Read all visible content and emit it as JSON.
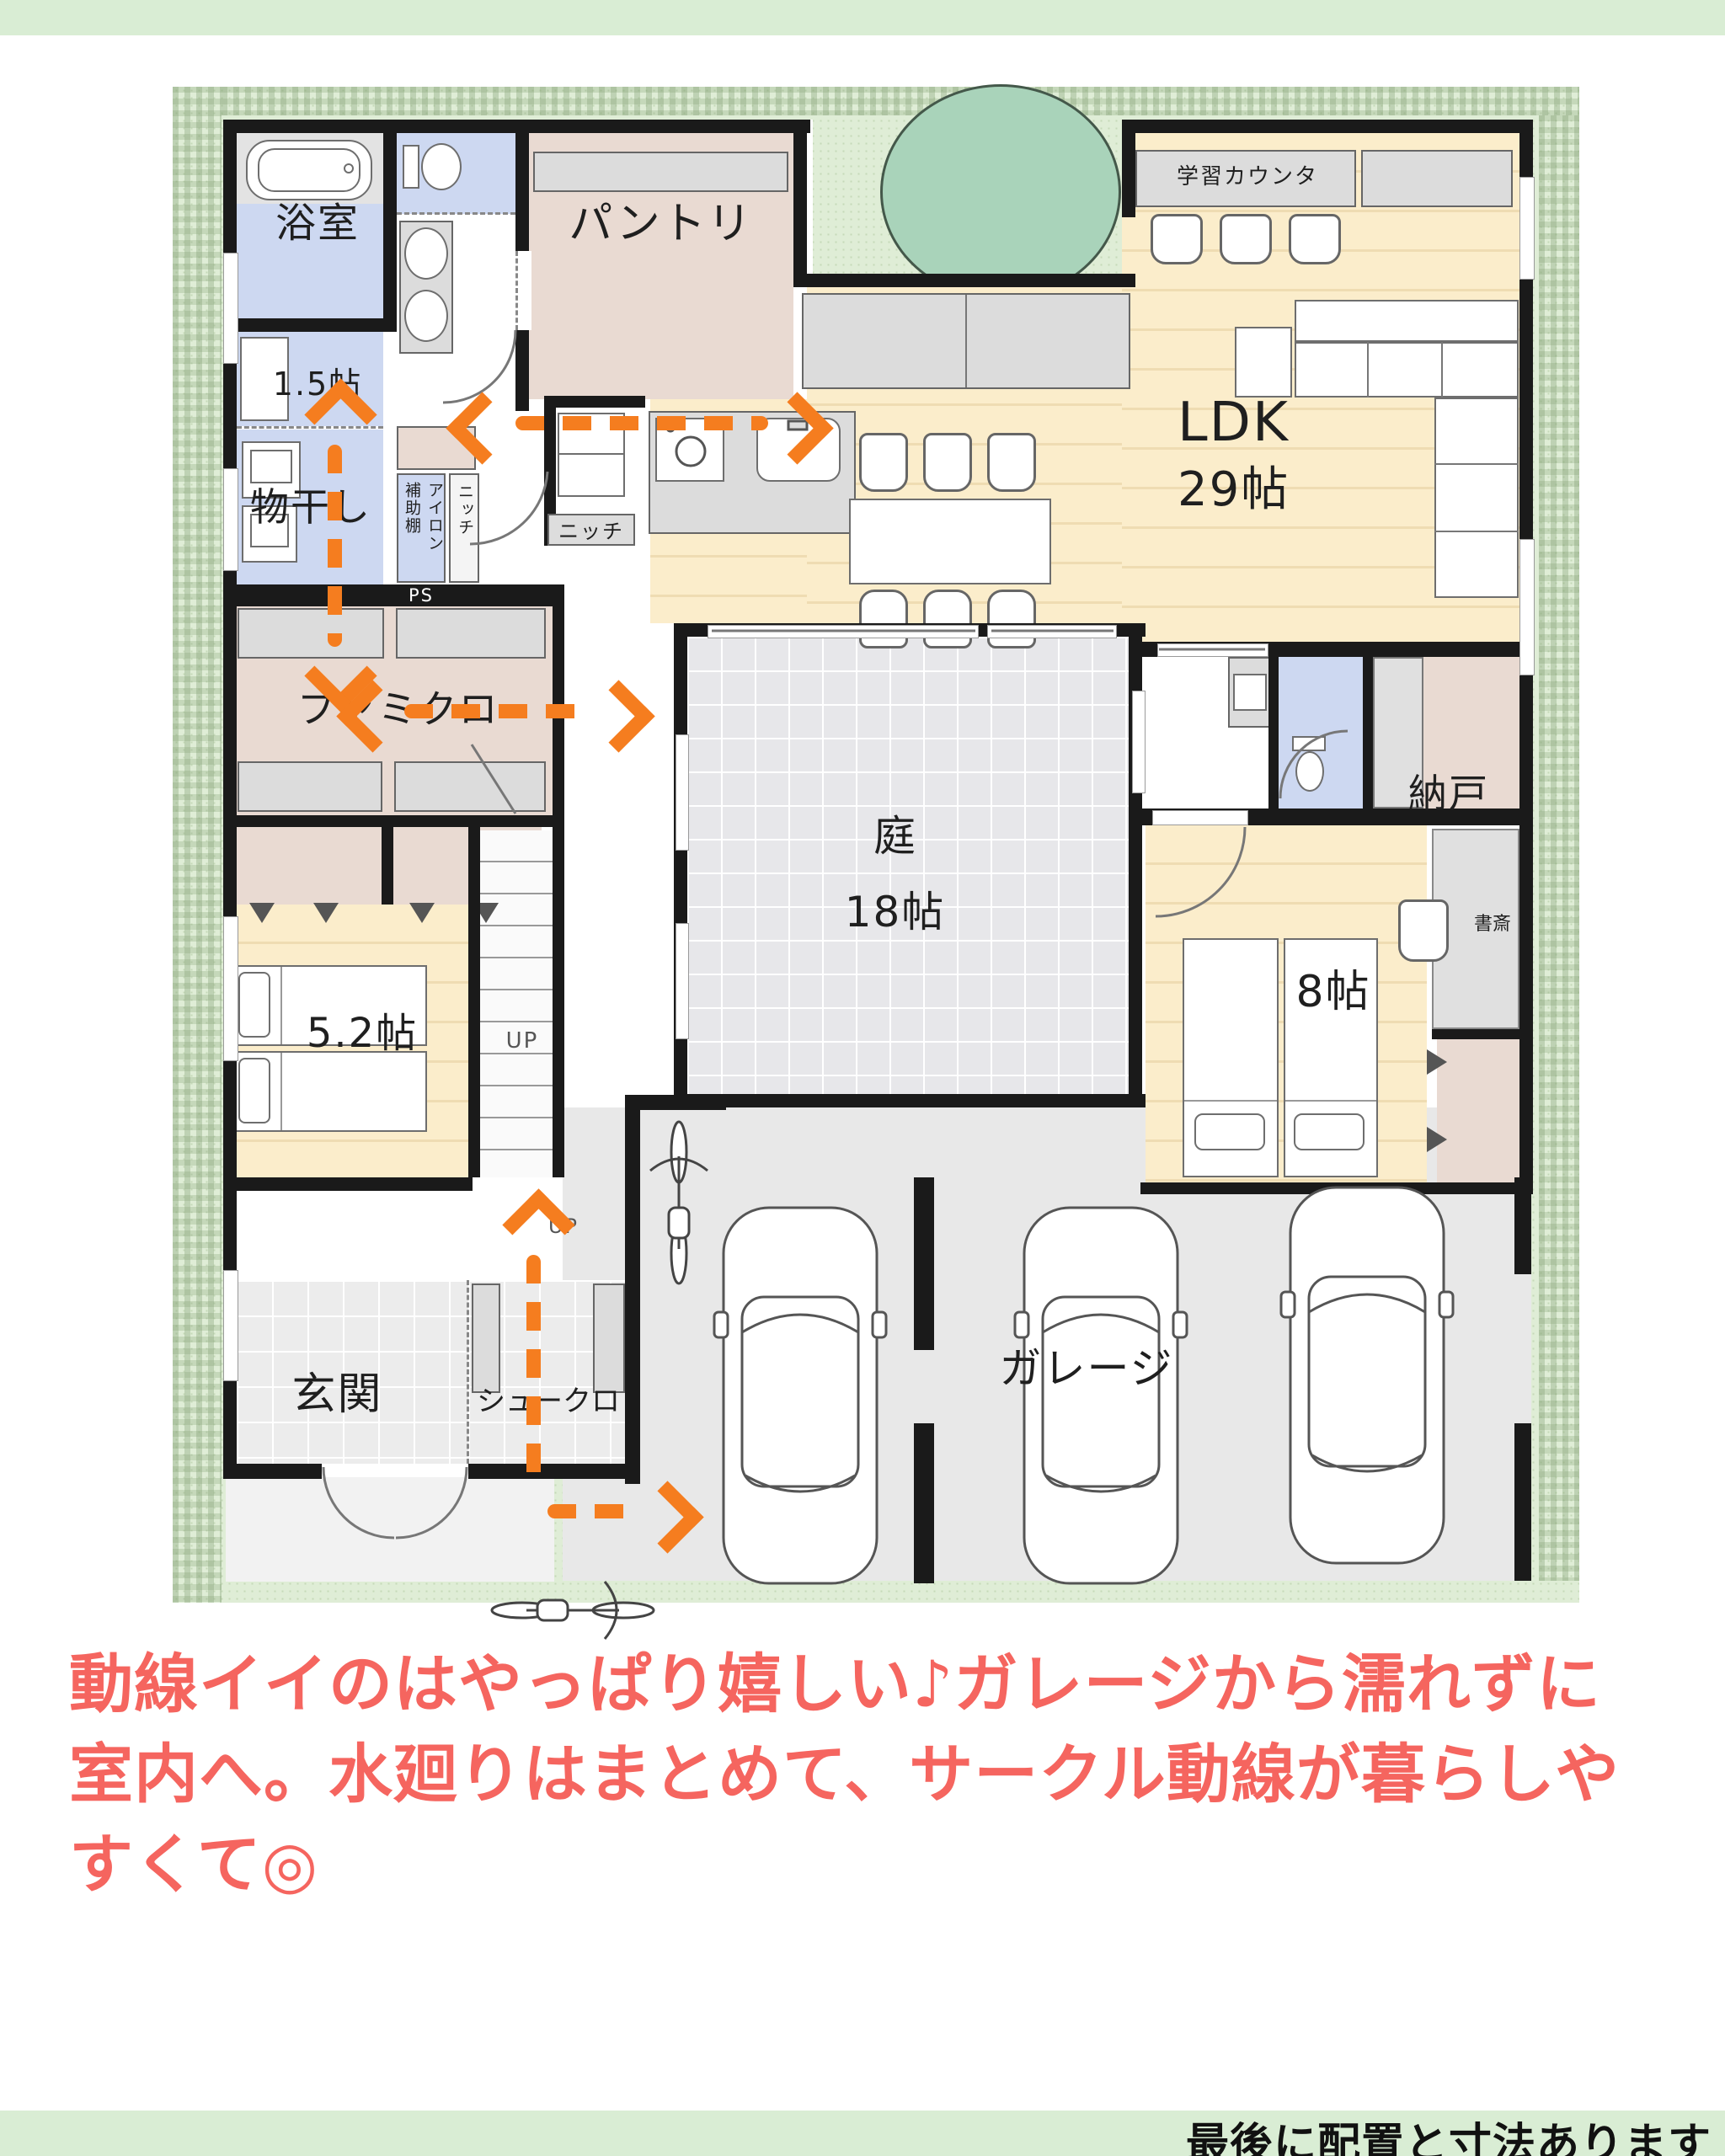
{
  "colors": {
    "accent_orange": "#F57D1F",
    "caption_pink": "#F5655F",
    "wall_black": "#1A1A1A",
    "site_green": "#DFEDD6",
    "strip_green": "#D9EDD4",
    "room_lavender": "#CDD8F1",
    "room_pink": "#E9DAD2",
    "floor_cream": "#FBEDCB",
    "tree_green": "#A9D3BA"
  },
  "plan": {
    "rooms": {
      "bathroom": "浴室",
      "wc_small": "1.5帖",
      "laundry": "物干し",
      "aux_shelf": "補助棚",
      "iron": "アイロン",
      "niche": "ニッチ",
      "niche_kitchen": "ニッチ",
      "ps": "PS",
      "pantry": "パントリ",
      "study_counter": "学習カウンタ",
      "ldk": "LDK",
      "ldk_size": "29帖",
      "famiclo": "ファミクロ",
      "bedroom_small": "5.2帖",
      "genkan": "玄関",
      "shoe_closet": "シュークロ",
      "garage": "ガレージ",
      "courtyard": "庭",
      "courtyard_size": "18帖",
      "storage": "納戸",
      "bedroom_main": "8帖",
      "study": "書斎"
    },
    "labels": {
      "up": "UP"
    }
  },
  "caption": {
    "line1": "動線イイのはやっぱり嬉しい♪ガレージから濡れずに",
    "line2": "室内へ。水廻りはまとめて、サークル動線が暮らしや",
    "line3": "すくて◎"
  },
  "footer": {
    "text": "最後に配置と寸法あります"
  }
}
